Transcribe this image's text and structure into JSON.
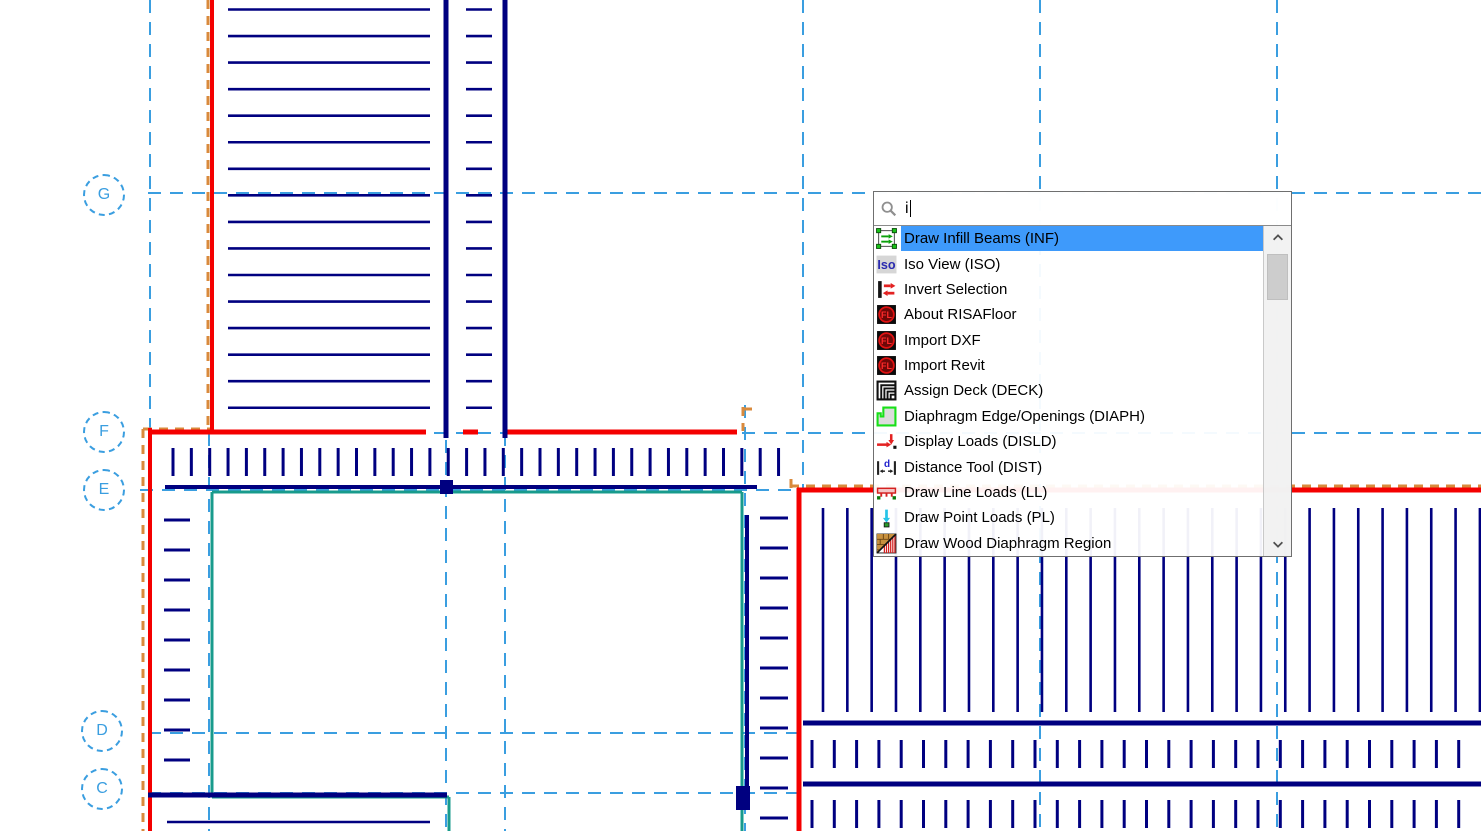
{
  "palette": {
    "navy": "#000080",
    "red": "#F40000",
    "orange": "#D98A3C",
    "teal": "#189B8C",
    "grid_blue": "#3A9EE0",
    "highlight_blue": "#3E9AFB"
  },
  "grid": {
    "labels": [
      "G",
      "F",
      "E",
      "D",
      "C"
    ]
  },
  "command_palette": {
    "search": {
      "value": "i",
      "icon": "search-icon"
    },
    "items": [
      {
        "label": "Draw Infill Beams (INF)",
        "icon": "infill-beams",
        "selected": true
      },
      {
        "label": "Iso View (ISO)",
        "icon": "iso-view",
        "selected": false
      },
      {
        "label": "Invert Selection",
        "icon": "invert-selection",
        "selected": false
      },
      {
        "label": "About RISAFloor",
        "icon": "risa-logo",
        "selected": false
      },
      {
        "label": "Import DXF",
        "icon": "risa-logo",
        "selected": false
      },
      {
        "label": "Import Revit",
        "icon": "risa-logo",
        "selected": false
      },
      {
        "label": "Assign Deck (DECK)",
        "icon": "assign-deck",
        "selected": false
      },
      {
        "label": "Diaphragm Edge/Openings (DIAPH)",
        "icon": "diaphragm-edge",
        "selected": false
      },
      {
        "label": "Display Loads (DISLD)",
        "icon": "display-loads",
        "selected": false
      },
      {
        "label": "Distance Tool (DIST)",
        "icon": "distance-tool",
        "selected": false
      },
      {
        "label": "Draw Line Loads (LL)",
        "icon": "line-loads",
        "selected": false
      },
      {
        "label": "Draw Point Loads (PL)",
        "icon": "point-loads",
        "selected": false
      },
      {
        "label": "Draw Wood Diaphragm Region",
        "icon": "wood-diaphragm",
        "selected": false
      }
    ],
    "scrollbar": {
      "up_icon": "chevron-up-icon",
      "down_icon": "chevron-down-icon"
    }
  }
}
